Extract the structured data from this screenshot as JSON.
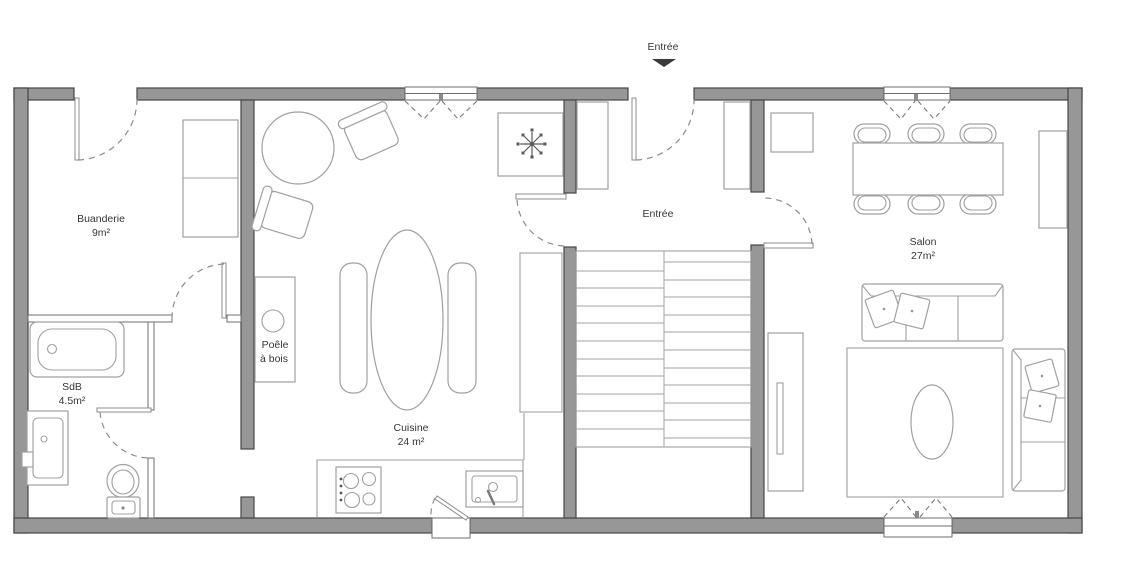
{
  "meta": {
    "kind": "architectural floor plan (ground floor)"
  },
  "colors": {
    "wall_fill": "#979797",
    "wall_stroke": "#474747",
    "partition_stroke": "#6f6f6f",
    "furniture_stroke": "#a0a0a0",
    "door_stroke": "#8c8c8c",
    "text_color": "#363636",
    "background": "#ffffff"
  },
  "entrance_marker": {
    "label": "Entrée",
    "arrow": "down-triangle"
  },
  "rooms": [
    {
      "id": "buanderie",
      "name": "Buanderie",
      "area": "9m²"
    },
    {
      "id": "sdb",
      "name": "SdB",
      "area": "4.5m²"
    },
    {
      "id": "cuisine",
      "name": "Cuisine",
      "area": "24 m²"
    },
    {
      "id": "entree",
      "name": "Entrée",
      "area": ""
    },
    {
      "id": "salon",
      "name": "Salon",
      "area": "27m²"
    }
  ],
  "annotations": {
    "wood_stove_line1": "Poêle",
    "wood_stove_line2": "à bois"
  }
}
